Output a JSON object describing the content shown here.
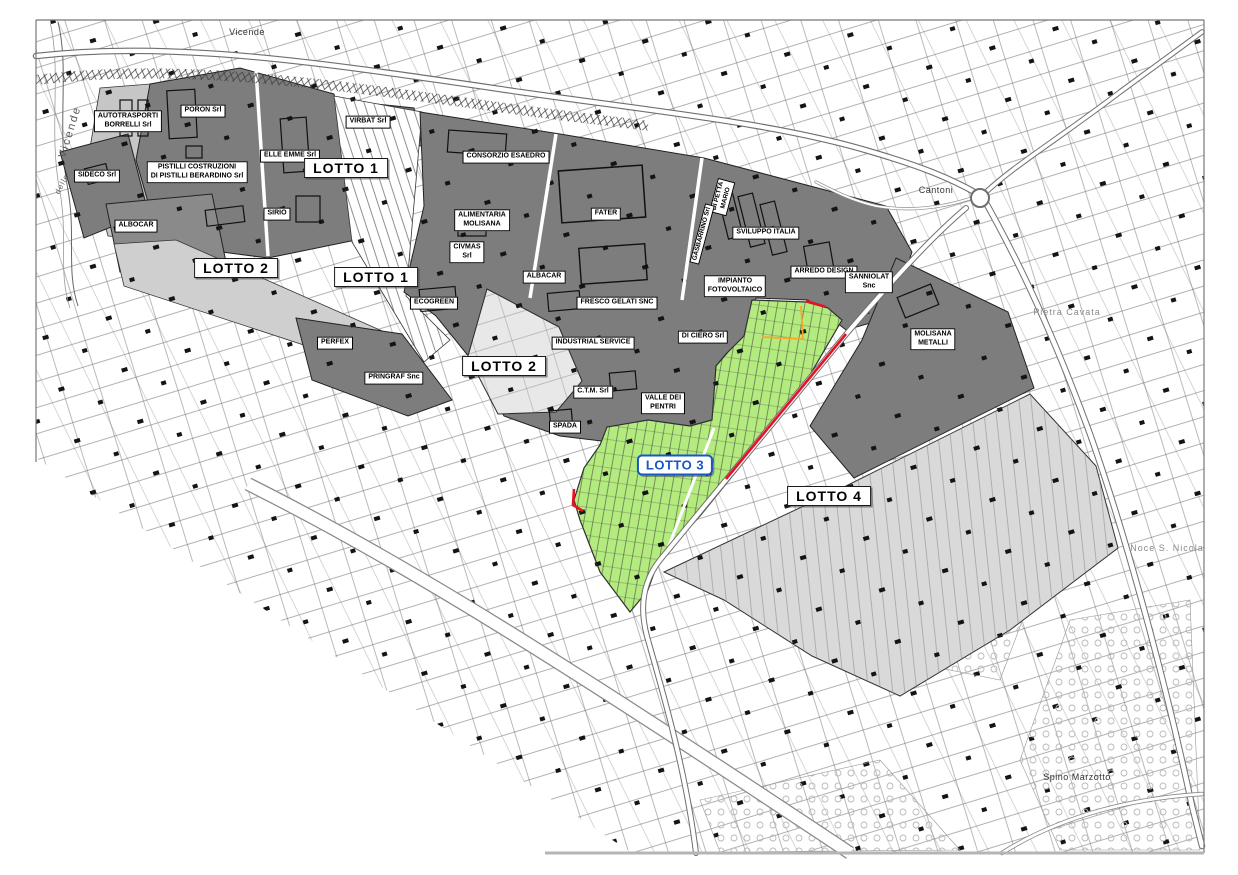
{
  "map": {
    "description": "Cadastral plan of industrial zone with lots",
    "colors": {
      "paper": "#ffffff",
      "dark_parcels": "#7d7d7d",
      "medium_parcels": "#c6c6c6",
      "light_parcels": "#d9d9d9",
      "lighter_parcels": "#e8e8e8",
      "lotto3_green": "#b4eb7f",
      "boundary_red": "#e81123",
      "utility_orange": "#ffa424",
      "lotto3_blue": "#1557c8"
    },
    "labels": [
      {
        "id": "autotrasporti-borrelli",
        "type": "company",
        "lines": [
          "AUTOTRASPORTI",
          "BORRELLI Srl"
        ],
        "x": 128,
        "y": 121
      },
      {
        "id": "poron",
        "type": "company",
        "lines": [
          "PORON Srl"
        ],
        "x": 203,
        "y": 111
      },
      {
        "id": "elle-emme",
        "type": "company",
        "lines": [
          "ELLE EMME Srl"
        ],
        "x": 290,
        "y": 156
      },
      {
        "id": "virbat",
        "type": "company",
        "lines": [
          "VIRBAT Srl"
        ],
        "x": 368,
        "y": 122
      },
      {
        "id": "sideco",
        "type": "company",
        "lines": [
          "SIDECO Srl"
        ],
        "x": 97,
        "y": 176
      },
      {
        "id": "pistilli-costruzioni",
        "type": "company",
        "lines": [
          "PISTILLI COSTRUZIONI",
          "DI PISTILLI BERARDINO Srl"
        ],
        "x": 197,
        "y": 172
      },
      {
        "id": "sirio",
        "type": "company",
        "lines": [
          "SIRIO"
        ],
        "x": 277,
        "y": 214
      },
      {
        "id": "albocar",
        "type": "company",
        "lines": [
          "ALBOCAR"
        ],
        "x": 136,
        "y": 226
      },
      {
        "id": "consorzio-esaedro",
        "type": "company",
        "lines": [
          "CONSORZIO ESAEDRO"
        ],
        "x": 506,
        "y": 157
      },
      {
        "id": "alimentaria-molisana",
        "type": "company",
        "lines": [
          "ALIMENTARIA",
          "MOLISANA"
        ],
        "x": 482,
        "y": 220
      },
      {
        "id": "civmas",
        "type": "company",
        "lines": [
          "CIVMAS",
          "Srl"
        ],
        "x": 467,
        "y": 252
      },
      {
        "id": "fater",
        "type": "company",
        "lines": [
          "FATER"
        ],
        "x": 606,
        "y": 214
      },
      {
        "id": "albacar",
        "type": "company",
        "lines": [
          "ALBACAR"
        ],
        "x": 544,
        "y": 277
      },
      {
        "id": "ecogreen",
        "type": "company",
        "lines": [
          "ECOGREEN"
        ],
        "x": 434,
        "y": 303
      },
      {
        "id": "fresco-gelati",
        "type": "company",
        "lines": [
          "FRESCO GELATI SNC"
        ],
        "x": 617,
        "y": 303
      },
      {
        "id": "industrial-service",
        "type": "company",
        "lines": [
          "INDUSTRIAL SERVICE"
        ],
        "x": 593,
        "y": 343
      },
      {
        "id": "sviluppo-italia",
        "type": "company",
        "lines": [
          "SVILUPPO ITALIA"
        ],
        "x": 766,
        "y": 233
      },
      {
        "id": "impianto-fotovoltaico",
        "type": "company",
        "lines": [
          "IMPIANTO",
          "FOTOVOLTAICO"
        ],
        "x": 735,
        "y": 286
      },
      {
        "id": "arredo-design",
        "type": "company",
        "lines": [
          "ARREDO DESIGN"
        ],
        "x": 824,
        "y": 272
      },
      {
        "id": "sanniolat",
        "type": "company",
        "lines": [
          "SANNIOLAT",
          "Snc"
        ],
        "x": 869,
        "y": 282
      },
      {
        "id": "molisana-metalli",
        "type": "company",
        "lines": [
          "MOLISANA",
          "METALLI"
        ],
        "x": 933,
        "y": 339
      },
      {
        "id": "di-ciero",
        "type": "company",
        "lines": [
          "DI CIERO Srl"
        ],
        "x": 703,
        "y": 337
      },
      {
        "id": "perfex",
        "type": "company",
        "lines": [
          "PERFEX"
        ],
        "x": 335,
        "y": 343
      },
      {
        "id": "pringraf",
        "type": "company",
        "lines": [
          "PRINGRAF Snc"
        ],
        "x": 394,
        "y": 378
      },
      {
        "id": "ctm",
        "type": "company",
        "lines": [
          "C.T.M. Srl"
        ],
        "x": 593,
        "y": 392
      },
      {
        "id": "valle-dei-pentri",
        "type": "company",
        "lines": [
          "VALLE DEI",
          "PENTRI"
        ],
        "x": 663,
        "y": 403
      },
      {
        "id": "spada",
        "type": "company",
        "lines": [
          "SPADA"
        ],
        "x": 565,
        "y": 427
      },
      {
        "id": "di-petta-mario",
        "type": "vlabel",
        "lines": [
          "DI PETTA",
          "MARIO"
        ],
        "x": 722,
        "y": 197,
        "rot": -75
      },
      {
        "id": "gasbarrino",
        "type": "vlabel",
        "lines": [
          "GASBARRINO Srl"
        ],
        "x": 702,
        "y": 234,
        "rot": -75
      },
      {
        "id": "lotto1-a",
        "type": "lot",
        "lines": [
          "LOTTO 1"
        ],
        "x": 346,
        "y": 168
      },
      {
        "id": "lotto2-a",
        "type": "lot",
        "lines": [
          "LOTTO 2"
        ],
        "x": 236,
        "y": 268
      },
      {
        "id": "lotto1-b",
        "type": "lot",
        "lines": [
          "LOTTO 1"
        ],
        "x": 376,
        "y": 277
      },
      {
        "id": "lotto2-b",
        "type": "lot",
        "lines": [
          "LOTTO 2"
        ],
        "x": 504,
        "y": 366
      },
      {
        "id": "lotto4",
        "type": "lot",
        "lines": [
          "LOTTO 4"
        ],
        "x": 829,
        "y": 496
      },
      {
        "id": "lotto3",
        "type": "lot-highlight",
        "lines": [
          "LOTTO 3"
        ],
        "x": 675,
        "y": 465
      },
      {
        "id": "vicende-top",
        "type": "place",
        "lines": [
          "Vicende"
        ],
        "x": 247,
        "y": 32
      },
      {
        "id": "vicende-river",
        "type": "place",
        "variant": "river",
        "lines": [
          "Vicende"
        ],
        "x": 70,
        "y": 132,
        "rot": -73
      },
      {
        "id": "delle",
        "type": "place",
        "variant": "riversmall",
        "lines": [
          "delle"
        ],
        "x": 62,
        "y": 184,
        "rot": -62
      },
      {
        "id": "cantoni",
        "type": "place",
        "lines": [
          "Cantoni"
        ],
        "x": 936,
        "y": 190
      },
      {
        "id": "pietra-cavata",
        "type": "place",
        "variant": "gray",
        "lines": [
          "Pietra Cavata"
        ],
        "x": 1067,
        "y": 312
      },
      {
        "id": "noce-s-nicola",
        "type": "place",
        "variant": "gray",
        "lines": [
          "Noce S. Nicola"
        ],
        "x": 1167,
        "y": 548
      },
      {
        "id": "spino-marzotto",
        "type": "place",
        "lines": [
          "Spino Marzotto"
        ],
        "x": 1077,
        "y": 777
      }
    ]
  }
}
